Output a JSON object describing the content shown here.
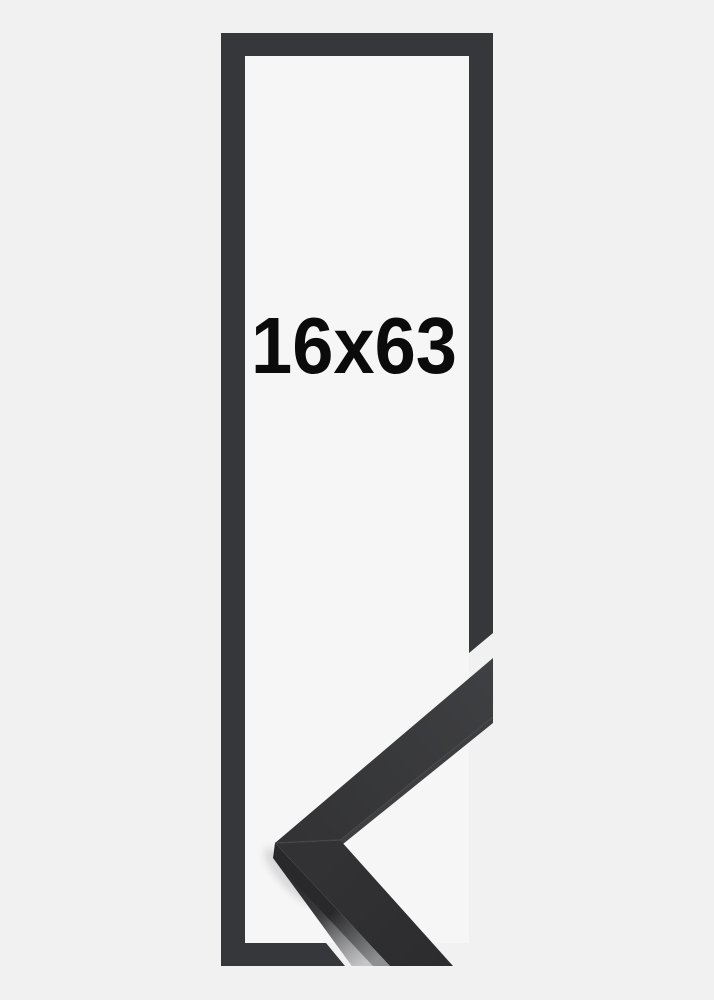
{
  "frame_illustration": {
    "size_label": "16x63",
    "colors": {
      "background": "#f1f1f2",
      "inner_background": "#f6f6f7",
      "outline_frame": "#36373a",
      "moulding_base": "#323234",
      "moulding_light": "#3f4043",
      "moulding_lower_dark": "#2c2c2e",
      "moulding_side_dark": "#29292b",
      "moulding_side_light": "#8f9092",
      "moulding_edge_highlight": "#c9c9cb",
      "moulding_underside": "#1f1f21",
      "miter_seam": "#47484b",
      "label_text": "#0b0b0b",
      "shadow": "#000000"
    }
  }
}
